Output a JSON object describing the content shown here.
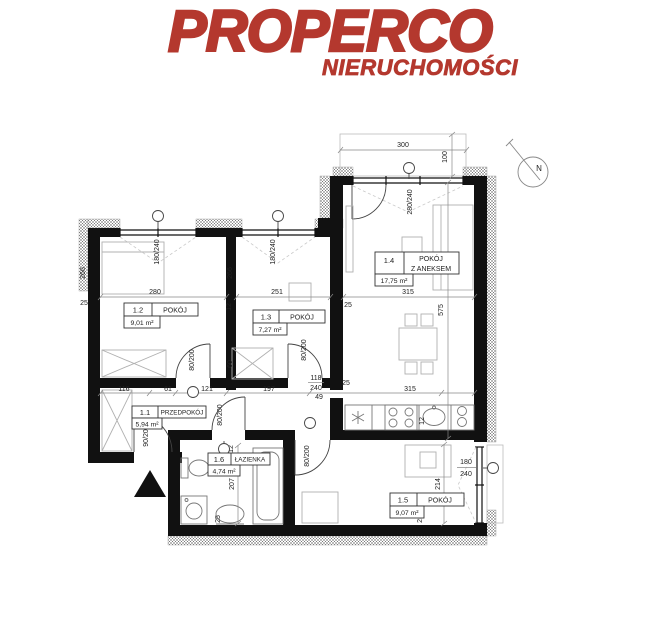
{
  "brand": {
    "name": "PROPERCO",
    "tagline": "NIERUCHOMOŚCI",
    "color": "#b4382e"
  },
  "compass": {
    "label": "N"
  },
  "floorplan": {
    "rooms": {
      "r11": {
        "id": "1.1",
        "name": "PRZEDPOKÓJ",
        "area": "5,94 m²"
      },
      "r12": {
        "id": "1.2",
        "name": "POKÓJ",
        "area": "9,01 m²"
      },
      "r13": {
        "id": "1.3",
        "name": "POKÓJ",
        "area": "7,27 m²"
      },
      "r14": {
        "id": "1.4",
        "name_line1": "POKÓJ",
        "name_line2": "Z ANEKSEM",
        "area": "17,75 m²"
      },
      "r15": {
        "id": "1.5",
        "name": "POKÓJ",
        "area": "9,07 m²"
      },
      "r16": {
        "id": "1.6",
        "name": "ŁAZIENKA",
        "area": "4,74 m²"
      }
    },
    "dims": {
      "balcony_width": "300",
      "balcony_depth": "100",
      "window_14": "280/240",
      "window_12": "180/240",
      "window_13": "180/240",
      "window_15_w": "180",
      "window_15_h": "240",
      "width_12": "280",
      "width_13": "251",
      "width_14": "315",
      "depth_12": "266",
      "depth_13": "266",
      "depth_14": "575",
      "depth_16": "207",
      "depth_15": "214",
      "wall_left": "25",
      "wall_12_13": "12",
      "wall_13_14": "25",
      "wall_16": "12",
      "wall_kitchen": "12",
      "wall_15": "25",
      "wall_16b": "25",
      "seg_60": "60",
      "hall_segments": [
        "116",
        "61",
        "121",
        "197",
        "315"
      ],
      "door_12": "80/200",
      "door_13": "80/200",
      "door_16": "80/200",
      "door_15": "80/200",
      "door_entry": "90/200",
      "opening_w": "118",
      "opening_h": "240",
      "opening_off": "49",
      "opening_wall": "25"
    }
  }
}
